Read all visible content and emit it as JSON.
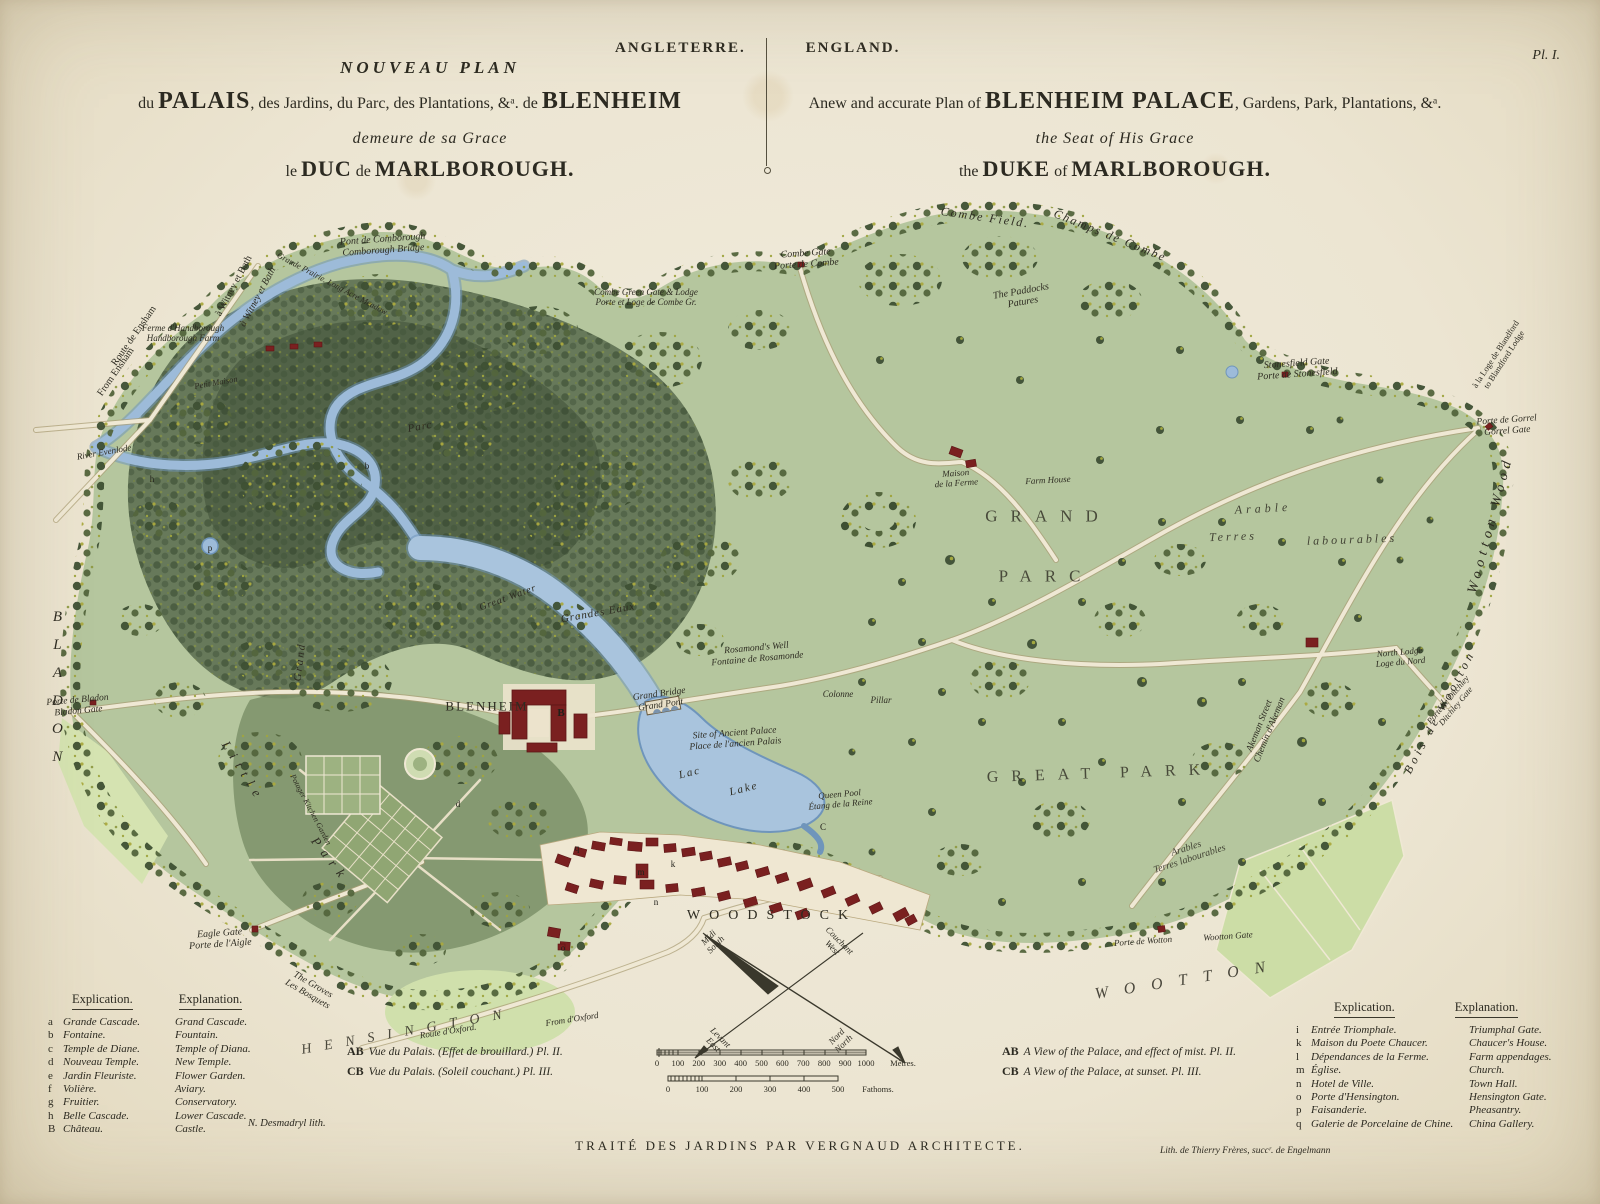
{
  "palette": {
    "paper": "#ede7d6",
    "ink": "#2c2a21",
    "park_green": "#b5c69e",
    "wood_dark": "#5c6e50",
    "water": "#9dbbd9",
    "building_red": "#7a2020",
    "road_cream": "#efe8d4",
    "field_pale": "#ccdda6"
  },
  "plate": {
    "series_fr": "ANGLETERRE.",
    "series_en": "ENGLAND.",
    "plate_no": "Pl. I."
  },
  "title_fr": {
    "line1": "NOUVEAU PLAN",
    "line2_pre": "du ",
    "line2_palais": "PALAIS",
    "line2_mid": ", des Jardins, du Parc, des Plantations, &ᵃ. de ",
    "line2_blenheim": "BLENHEIM",
    "line3": "demeure de sa Grace",
    "line4_pre": "le ",
    "line4_big1": "DUC",
    "line4_mid": " de ",
    "line4_big2": "MARLBOROUGH."
  },
  "title_en": {
    "line2_pre": "Anew and accurate Plan of ",
    "line2_big": "BLENHEIM PALACE",
    "line2_post": ", Gardens, Park, Plantations, &ᵃ.",
    "line3": "the Seat of His Grace",
    "line4_pre": "the ",
    "line4_big1": "DUKE",
    "line4_mid": " of ",
    "line4_big2": "MARLBOROUGH."
  },
  "legend_left": {
    "header_fr": "Explication.",
    "header_en": "Explanation.",
    "rows": [
      {
        "k": "a",
        "fr": "Grande Cascade.",
        "en": "Grand Cascade."
      },
      {
        "k": "b",
        "fr": "Fontaine.",
        "en": "Fountain."
      },
      {
        "k": "c",
        "fr": "Temple de Diane.",
        "en": "Temple of Diana."
      },
      {
        "k": "d",
        "fr": "Nouveau Temple.",
        "en": "New Temple."
      },
      {
        "k": "e",
        "fr": "Jardin Fleuriste.",
        "en": "Flower Garden."
      },
      {
        "k": "f",
        "fr": "Volière.",
        "en": "Aviary."
      },
      {
        "k": "g",
        "fr": "Fruitier.",
        "en": "Conservatory."
      },
      {
        "k": "h",
        "fr": "Belle Cascade.",
        "en": "Lower Cascade."
      },
      {
        "k": "B",
        "fr": "Château.",
        "en": "Castle."
      }
    ]
  },
  "legend_right": {
    "header_fr": "Explication.",
    "header_en": "Explanation.",
    "rows": [
      {
        "k": "i",
        "fr": "Entrée Triomphale.",
        "en": "Triumphal Gate."
      },
      {
        "k": "k",
        "fr": "Maison du Poete Chaucer.",
        "en": "Chaucer's House."
      },
      {
        "k": "l",
        "fr": "Dépendances de la Ferme.",
        "en": "Farm appendages."
      },
      {
        "k": "m",
        "fr": "Église.",
        "en": "Church."
      },
      {
        "k": "n",
        "fr": "Hotel de Ville.",
        "en": "Town Hall."
      },
      {
        "k": "o",
        "fr": "Porte d'Hensington.",
        "en": "Hensington Gate."
      },
      {
        "k": "p",
        "fr": "Faisanderie.",
        "en": "Pheasantry."
      },
      {
        "k": "q",
        "fr": "Galerie de Porcelaine de Chine.",
        "en": "China Gallery."
      }
    ]
  },
  "notes_fr": {
    "ab_key": "AB",
    "ab": "Vue du Palais. (Effet de brouillard.) Pl. II.",
    "cb_key": "CB",
    "cb": "Vue du Palais. (Soleil couchant.) Pl. III."
  },
  "notes_en": {
    "ab_key": "AB",
    "ab": "A View of the Palace, and effect of mist. Pl. II.",
    "cb_key": "CB",
    "cb": "A View of the Palace, at sunset. Pl. III."
  },
  "imprints": {
    "treatise": "TRAITÉ DES JARDINS PAR VERGNAUD ARCHITECTE.",
    "lith_artist": "N. Desmadryl lith.",
    "lith_printer": "Lith. de Thierry Frères, succʳ. de Engelmann"
  },
  "scalebars": {
    "metres": {
      "ticks": [
        "0",
        "100",
        "200",
        "300",
        "400",
        "500",
        "600",
        "700",
        "800",
        "900",
        "1000"
      ],
      "unit": "Mètres."
    },
    "fathoms": {
      "ticks": [
        "0",
        "100",
        "200",
        "300",
        "400",
        "500"
      ],
      "unit": "Fathoms."
    }
  },
  "map": {
    "labels": [
      {
        "n": "comborough-bridge",
        "l": [
          "Pont de Comborough",
          "Comborough Bridge"
        ],
        "x": 383,
        "y": 245,
        "r": -4,
        "s": 10,
        "i": 1
      },
      {
        "n": "to-witney-bath",
        "l": [
          "à Witney et Bath"
        ],
        "x": 234,
        "y": 286,
        "r": -62,
        "s": 10,
        "i": 0
      },
      {
        "n": "to-witney-bath-2",
        "l": [
          "à Witney et Bath"
        ],
        "x": 258,
        "y": 297,
        "r": -62,
        "s": 10,
        "i": 1
      },
      {
        "n": "route-ensham-fr",
        "l": [
          "Route de Ensham"
        ],
        "x": 134,
        "y": 336,
        "r": -55,
        "s": 10,
        "i": 0
      },
      {
        "n": "route-ensham-en",
        "l": [
          "From Ensham"
        ],
        "x": 116,
        "y": 372,
        "r": -55,
        "s": 10,
        "i": 0
      },
      {
        "n": "handborough-farm",
        "l": [
          "Ferme d'Handborough",
          "Handborough Farm"
        ],
        "x": 183,
        "y": 333,
        "r": 0,
        "s": 9,
        "i": 1
      },
      {
        "n": "petit-maison",
        "l": [
          "Petit Maison"
        ],
        "x": 216,
        "y": 383,
        "r": -10,
        "s": 8.5,
        "i": 1
      },
      {
        "n": "long-acre-meadow",
        "l": [
          "Grande Prairie. Long Acre Meadow"
        ],
        "x": 332,
        "y": 284,
        "r": 28,
        "s": 8.5,
        "i": 1
      },
      {
        "n": "combe-green-gate",
        "l": [
          "Combe Green Gate & Lodge",
          "Porte et Loge de Combe Gr."
        ],
        "x": 646,
        "y": 297,
        "r": 0,
        "s": 9,
        "i": 1
      },
      {
        "n": "combe-gate",
        "l": [
          "Combe Gate",
          "Porte de Combe"
        ],
        "x": 806,
        "y": 259,
        "r": -4,
        "s": 10,
        "i": 1
      },
      {
        "n": "combe-field",
        "l": [
          "Combe Field."
        ],
        "x": 985,
        "y": 218,
        "r": 8,
        "s": 12,
        "sp": 2,
        "i": 1
      },
      {
        "n": "champs-de-combe",
        "l": [
          "Champs de Combe"
        ],
        "x": 1110,
        "y": 236,
        "r": 22,
        "s": 12,
        "sp": 2,
        "i": 1
      },
      {
        "n": "the-paddocks",
        "l": [
          "The Paddocks",
          "Patures"
        ],
        "x": 1022,
        "y": 297,
        "r": -10,
        "s": 10,
        "i": 1
      },
      {
        "n": "stonesfield-gate",
        "l": [
          "Stonesfield Gate",
          "Porte de Stonesfield"
        ],
        "x": 1297,
        "y": 369,
        "r": -4,
        "s": 10,
        "i": 1
      },
      {
        "n": "blandford-lodge",
        "l": [
          "à la Loge de Blandford",
          "to Blandford Lodge"
        ],
        "x": 1500,
        "y": 357,
        "r": -57,
        "s": 8.5,
        "i": 0
      },
      {
        "n": "gorrel-gate",
        "l": [
          "Porte de Gorrel",
          "Gorrel Gate"
        ],
        "x": 1507,
        "y": 426,
        "r": -4,
        "s": 9.5,
        "i": 1
      },
      {
        "n": "wootton-wood",
        "l": [
          "Wootton Wood"
        ],
        "x": 1491,
        "y": 525,
        "r": -75,
        "s": 14,
        "sp": 5,
        "i": 1
      },
      {
        "n": "bois-de-wootton",
        "l": [
          "Bois de Wootton"
        ],
        "x": 1440,
        "y": 712,
        "r": -62,
        "s": 12,
        "sp": 4,
        "i": 1
      },
      {
        "n": "ditchley-gate",
        "l": [
          "Porte de Ditchley",
          "Ditchley Gate"
        ],
        "x": 1452,
        "y": 703,
        "r": -50,
        "s": 8.5,
        "i": 1
      },
      {
        "n": "river-evenlode",
        "l": [
          "River Evenlode"
        ],
        "x": 104,
        "y": 452,
        "r": -10,
        "s": 9,
        "i": 1
      },
      {
        "n": "parc-west",
        "l": [
          "Parc"
        ],
        "x": 420,
        "y": 427,
        "r": -10,
        "s": 11,
        "sp": 1,
        "i": 1
      },
      {
        "n": "bladon-region",
        "l": [
          "BLADON"
        ],
        "x": 57,
        "y": 693,
        "r": 0,
        "s": 15,
        "sp": 12,
        "i": 1,
        "k": "vert"
      },
      {
        "n": "bladon-gate",
        "l": [
          "Porte de Bladon",
          "Bladon Gate"
        ],
        "x": 78,
        "y": 706,
        "r": -5,
        "s": 9.5,
        "i": 1
      },
      {
        "n": "little-park-little",
        "l": [
          "Little"
        ],
        "x": 243,
        "y": 772,
        "r": 58,
        "s": 13,
        "sp": 7,
        "i": 1
      },
      {
        "n": "little-park-park",
        "l": [
          "Park"
        ],
        "x": 330,
        "y": 860,
        "r": 52,
        "s": 13,
        "sp": 7,
        "i": 1
      },
      {
        "n": "grand-avenue",
        "l": [
          "Grand"
        ],
        "x": 300,
        "y": 662,
        "r": -83,
        "s": 11,
        "sp": 2,
        "i": 1
      },
      {
        "n": "potager-garden",
        "l": [
          "Potager Kitchen Garden"
        ],
        "x": 310,
        "y": 810,
        "r": 62,
        "s": 8,
        "i": 1
      },
      {
        "n": "great-water",
        "l": [
          "Great Water"
        ],
        "x": 508,
        "y": 598,
        "r": -20,
        "s": 10,
        "sp": 1,
        "i": 1
      },
      {
        "n": "grandes-eaux",
        "l": [
          "Grandes Eaux"
        ],
        "x": 598,
        "y": 613,
        "r": -10,
        "s": 11,
        "sp": 1,
        "i": 1
      },
      {
        "n": "rosamonds-well",
        "l": [
          "Rosamond's Well",
          "Fontaine de Rosamonde"
        ],
        "x": 757,
        "y": 654,
        "r": -5,
        "s": 9.5,
        "i": 1
      },
      {
        "n": "blenheim-palace",
        "l": [
          "BLENHEIM"
        ],
        "x": 487,
        "y": 707,
        "r": 0,
        "s": 13,
        "sp": 2,
        "i": 0
      },
      {
        "n": "grand-bridge",
        "l": [
          "Grand Bridge",
          "Grand Pont"
        ],
        "x": 660,
        "y": 700,
        "r": -8,
        "s": 9.5,
        "i": 1
      },
      {
        "n": "ancient-palace",
        "l": [
          "Site of Ancient Palace",
          "Place de l'ancien Palais"
        ],
        "x": 735,
        "y": 739,
        "r": -4,
        "s": 9.5,
        "i": 1
      },
      {
        "n": "lac",
        "l": [
          "Lac"
        ],
        "x": 690,
        "y": 773,
        "r": -14,
        "s": 11,
        "sp": 2,
        "i": 1
      },
      {
        "n": "lake",
        "l": [
          "Lake"
        ],
        "x": 744,
        "y": 789,
        "r": -14,
        "s": 11,
        "sp": 2,
        "i": 1
      },
      {
        "n": "colonne",
        "l": [
          "Colonne"
        ],
        "x": 838,
        "y": 694,
        "r": 0,
        "s": 9,
        "i": 1
      },
      {
        "n": "pillar",
        "l": [
          "Pillar"
        ],
        "x": 881,
        "y": 700,
        "r": 0,
        "s": 9,
        "i": 1
      },
      {
        "n": "queen-pool",
        "l": [
          "Queen Pool",
          "Étang de la Reine"
        ],
        "x": 840,
        "y": 799,
        "r": -5,
        "s": 9,
        "i": 1
      },
      {
        "n": "grand-parc-grand",
        "l": [
          "GRAND"
        ],
        "x": 1048,
        "y": 516,
        "r": 0,
        "s": 17,
        "sp": 13,
        "i": 0,
        "o": 0.8
      },
      {
        "n": "grand-parc-parc",
        "l": [
          "PARC"
        ],
        "x": 1046,
        "y": 576,
        "r": 0,
        "s": 17,
        "sp": 13,
        "i": 0,
        "o": 0.8
      },
      {
        "n": "maison-de-la-ferme",
        "l": [
          "Maison",
          "de la Ferme"
        ],
        "x": 956,
        "y": 478,
        "r": -4,
        "s": 9,
        "i": 1
      },
      {
        "n": "farm-house",
        "l": [
          "Farm House"
        ],
        "x": 1048,
        "y": 480,
        "r": -3,
        "s": 9,
        "i": 1
      },
      {
        "n": "arable-north",
        "l": [
          "Arable"
        ],
        "x": 1263,
        "y": 509,
        "r": -3,
        "s": 12,
        "sp": 4,
        "i": 1,
        "o": 0.85
      },
      {
        "n": "terres-north",
        "l": [
          "Terres"
        ],
        "x": 1233,
        "y": 537,
        "r": -2,
        "s": 12,
        "sp": 3,
        "i": 1,
        "o": 0.85
      },
      {
        "n": "labourables-north",
        "l": [
          "labourables"
        ],
        "x": 1352,
        "y": 540,
        "r": -2,
        "s": 12,
        "sp": 3,
        "i": 1,
        "o": 0.85
      },
      {
        "n": "great-park",
        "l": [
          "GREAT PARK"
        ],
        "x": 1100,
        "y": 774,
        "r": -2,
        "s": 16,
        "sp": 13,
        "i": 0,
        "o": 0.8
      },
      {
        "n": "akeman-street",
        "l": [
          "Akeman Street",
          "Chemin d'Akeman"
        ],
        "x": 1265,
        "y": 728,
        "r": -68,
        "s": 9.5,
        "i": 1
      },
      {
        "n": "north-lodge",
        "l": [
          "North Lodge",
          "Loge du Nord"
        ],
        "x": 1400,
        "y": 657,
        "r": -5,
        "s": 9,
        "i": 1
      },
      {
        "n": "arables-south",
        "l": [
          "Arables",
          "Terres labourables"
        ],
        "x": 1188,
        "y": 854,
        "r": -18,
        "s": 10,
        "i": 1,
        "o": 0.85
      },
      {
        "n": "wotton-gate-fr",
        "l": [
          "Porte de Wotton"
        ],
        "x": 1143,
        "y": 941,
        "r": -4,
        "s": 9,
        "i": 1
      },
      {
        "n": "wootton-gate-en",
        "l": [
          "Wootton Gate"
        ],
        "x": 1228,
        "y": 936,
        "r": -4,
        "s": 9,
        "i": 1
      },
      {
        "n": "wootton-region",
        "l": [
          "WOOTTON"
        ],
        "x": 1188,
        "y": 980,
        "r": -9,
        "s": 16,
        "sp": 16,
        "i": 1,
        "o": 0.85
      },
      {
        "n": "eagle-gate",
        "l": [
          "Eagle Gate",
          "Porte de l'Aigle"
        ],
        "x": 220,
        "y": 939,
        "r": -4,
        "s": 10,
        "i": 1
      },
      {
        "n": "the-groves",
        "l": [
          "The Groves",
          "Les Bosquets"
        ],
        "x": 310,
        "y": 990,
        "r": 30,
        "s": 9.5,
        "i": 1
      },
      {
        "n": "route-oxford",
        "l": [
          "Route d'Oxford."
        ],
        "x": 448,
        "y": 1031,
        "r": -9,
        "s": 9,
        "i": 1
      },
      {
        "n": "from-oxford",
        "l": [
          "From d'Oxford"
        ],
        "x": 572,
        "y": 1019,
        "r": -9,
        "s": 9,
        "i": 1
      },
      {
        "n": "hensington-region",
        "l": [
          "HENSINGTON"
        ],
        "x": 408,
        "y": 1032,
        "r": -10,
        "s": 14,
        "sp": 13,
        "i": 1,
        "o": 0.85
      },
      {
        "n": "woodstock-town",
        "l": [
          "WOODSTOCK"
        ],
        "x": 772,
        "y": 916,
        "r": 0,
        "s": 14,
        "sp": 9,
        "i": 0
      },
      {
        "n": "compass-midi-south",
        "l": [
          "Midi",
          "South"
        ],
        "x": 712,
        "y": 941,
        "r": -45,
        "s": 9,
        "i": 1
      },
      {
        "n": "compass-couchant-west",
        "l": [
          "Couchant",
          "West"
        ],
        "x": 836,
        "y": 944,
        "r": 45,
        "s": 9,
        "i": 1
      },
      {
        "n": "compass-levant-east",
        "l": [
          "Levant",
          "East"
        ],
        "x": 717,
        "y": 1041,
        "r": 45,
        "s": 9,
        "i": 1
      },
      {
        "n": "compass-nord-north",
        "l": [
          "Nord",
          "North"
        ],
        "x": 840,
        "y": 1040,
        "r": -45,
        "s": 9,
        "i": 1
      }
    ],
    "markers": [
      {
        "t": "B",
        "x": 561,
        "y": 713,
        "b": 1
      },
      {
        "t": "C",
        "x": 823,
        "y": 827
      },
      {
        "t": "q",
        "x": 577,
        "y": 848
      },
      {
        "t": "m",
        "x": 641,
        "y": 872
      },
      {
        "t": "k",
        "x": 673,
        "y": 864
      },
      {
        "t": "n",
        "x": 656,
        "y": 902
      },
      {
        "t": "o",
        "x": 563,
        "y": 948
      },
      {
        "t": "d",
        "x": 458,
        "y": 804
      },
      {
        "t": "b",
        "x": 367,
        "y": 466
      },
      {
        "t": "h",
        "x": 152,
        "y": 479
      },
      {
        "t": "p",
        "x": 210,
        "y": 548
      }
    ]
  }
}
